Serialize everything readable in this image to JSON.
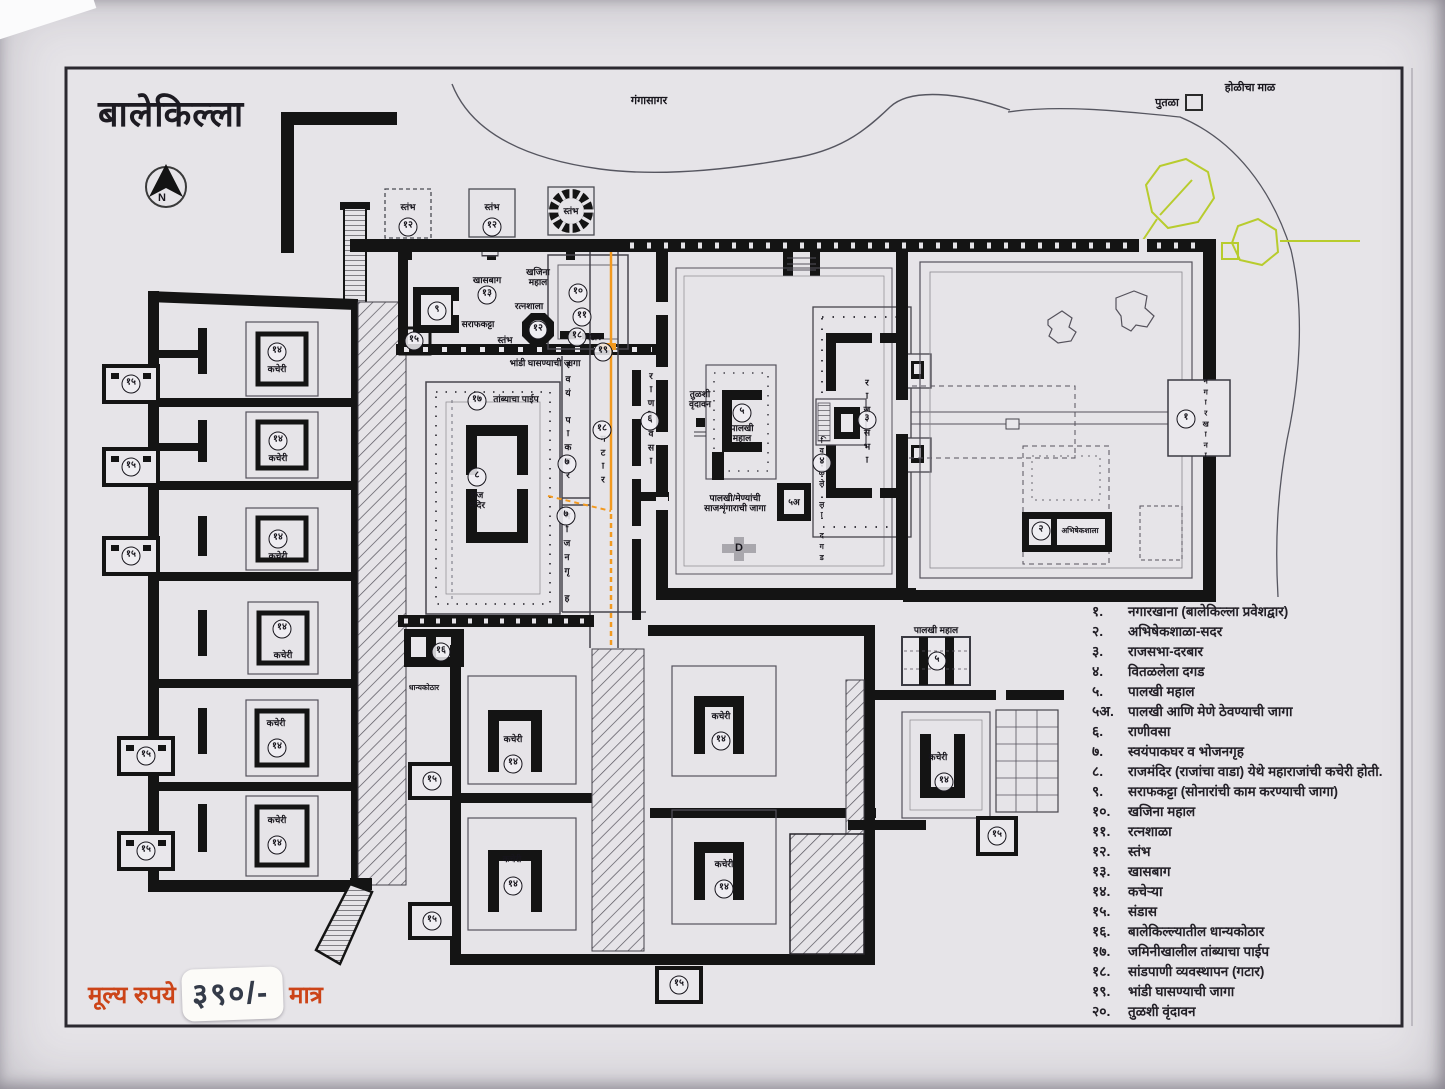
{
  "page": {
    "title": "बालेकिल्ला"
  },
  "price": {
    "prefix": "मूल्य रुपये",
    "value": "३९०/-",
    "suffix": "मात्र"
  },
  "colors": {
    "wall": "#141414",
    "paper": "#e6e4e8",
    "accent_green": "#b8cc2e",
    "accent_orange": "#f2991f",
    "price_red": "#cc4418"
  },
  "legend": {
    "items": [
      {
        "n": "१.",
        "t": "नगारखाना (बालेकिल्ला प्रवेशद्वार)"
      },
      {
        "n": "२.",
        "t": "अभिषेकशाळा-सदर"
      },
      {
        "n": "३.",
        "t": "राजसभा-दरबार"
      },
      {
        "n": "४.",
        "t": "वितळलेला दगड"
      },
      {
        "n": "५.",
        "t": "पालखी महाल"
      },
      {
        "n": "५अ.",
        "t": "पालखी आणि मेणे ठेवण्याची जागा"
      },
      {
        "n": "६.",
        "t": "राणीवसा"
      },
      {
        "n": "७.",
        "t": "स्वयंपाकघर व भोजनगृह"
      },
      {
        "n": "८.",
        "t": "राजमंदिर (राजांचा वाडा) येथे महाराजांची कचेरी होती."
      },
      {
        "n": "९.",
        "t": "सराफकट्टा (सोनारांची काम करण्याची जागा)"
      },
      {
        "n": "१०.",
        "t": "खजिना महाल"
      },
      {
        "n": "११.",
        "t": "रत्नशाळा"
      },
      {
        "n": "१२.",
        "t": "स्तंभ"
      },
      {
        "n": "१३.",
        "t": "खासबाग"
      },
      {
        "n": "१४.",
        "t": "कचेऱ्या"
      },
      {
        "n": "१५.",
        "t": "संडास"
      },
      {
        "n": "१६.",
        "t": "बालेकिल्ल्यातील धान्यकोठार"
      },
      {
        "n": "१७.",
        "t": "जमिनीखालील तांब्याचा पाईप"
      },
      {
        "n": "१८.",
        "t": "सांडपाणी व्यवस्थापन (गटार)"
      },
      {
        "n": "१९.",
        "t": "भांडी घासण्याची जागा"
      },
      {
        "n": "२०.",
        "t": "तुळशी वृंदावन"
      }
    ]
  },
  "plan": {
    "labels": [
      {
        "t": "गंगासागर",
        "x": 649,
        "y": 101
      },
      {
        "t": "होळीचा माळ",
        "x": 1250,
        "y": 88
      },
      {
        "t": "पुतळा",
        "x": 1167,
        "y": 103
      },
      {
        "t": "N",
        "x": 162,
        "y": 198
      },
      {
        "t": "स्तंभ",
        "x": 408,
        "y": 207,
        "s": 1
      },
      {
        "t": "स्तंभ",
        "x": 492,
        "y": 207,
        "s": 1
      },
      {
        "t": "स्तंभ",
        "x": 571,
        "y": 211,
        "s": 1
      },
      {
        "t": "खासबाग",
        "x": 487,
        "y": 280,
        "s": 1
      },
      {
        "t": "खजिना\nमहाल",
        "x": 538,
        "y": 277,
        "s": 1
      },
      {
        "t": "रत्नशाला",
        "x": 529,
        "y": 306,
        "s": 1
      },
      {
        "t": "सराफकट्टा",
        "x": 478,
        "y": 324,
        "s": 1
      },
      {
        "t": "स्तंभ",
        "x": 505,
        "y": 340,
        "s": 1
      },
      {
        "t": "गटार",
        "x": 593,
        "y": 337,
        "s": 1
      },
      {
        "t": "भांडी घासण्याची जागा",
        "x": 545,
        "y": 363,
        "s": 1
      },
      {
        "t": "तांब्याचा पाईप",
        "x": 516,
        "y": 399,
        "s": 1
      },
      {
        "t": "स्वयंपाकघर",
        "x": 567,
        "y": 420,
        "v": 1,
        "s": 1
      },
      {
        "t": "भोजनगृह",
        "x": 566,
        "y": 557,
        "v": 1,
        "s": 1
      },
      {
        "t": "गटार",
        "x": 602,
        "y": 459,
        "v": 1,
        "s": 1
      },
      {
        "t": "राणी",
        "x": 650,
        "y": 396,
        "v": 1,
        "s": 1
      },
      {
        "t": "वसा",
        "x": 650,
        "y": 447,
        "v": 1,
        "s": 1
      },
      {
        "t": "तुळशी\nवृंदावन",
        "x": 700,
        "y": 399,
        "s": 1
      },
      {
        "t": "राज\nमंदिर",
        "x": 477,
        "y": 500,
        "s": 1
      },
      {
        "t": "पालखी\nमहाल",
        "x": 742,
        "y": 433,
        "s": 1
      },
      {
        "t": "पालखी/मेण्यांची\nसाजशृंगाराची जागा",
        "x": 735,
        "y": 503,
        "s": 1
      },
      {
        "t": "५अ",
        "x": 794,
        "y": 502,
        "s": 1
      },
      {
        "t": "D",
        "x": 739,
        "y": 548
      },
      {
        "t": "राज",
        "x": 866,
        "y": 396,
        "v": 1,
        "s": 1
      },
      {
        "t": "सभा",
        "x": 866,
        "y": 446,
        "v": 1,
        "s": 1
      },
      {
        "t": "वितळलेला दगड",
        "x": 822,
        "y": 500,
        "v": 1,
        "xs": 1
      },
      {
        "t": "अभिषेकशाला",
        "x": 1080,
        "y": 531,
        "xs": 1
      },
      {
        "t": "नगारखाना",
        "x": 1206,
        "y": 419,
        "v": 1,
        "xs": 1
      },
      {
        "t": "कचेरी",
        "x": 277,
        "y": 369,
        "s": 1
      },
      {
        "t": "कचेरी",
        "x": 278,
        "y": 458,
        "s": 1
      },
      {
        "t": "कचेरी",
        "x": 278,
        "y": 556,
        "s": 1
      },
      {
        "t": "कचेरी",
        "x": 283,
        "y": 655,
        "s": 1
      },
      {
        "t": "कचेरी",
        "x": 276,
        "y": 723,
        "s": 1
      },
      {
        "t": "कचेरी",
        "x": 277,
        "y": 820,
        "s": 1
      },
      {
        "t": "कचेरी",
        "x": 513,
        "y": 739,
        "s": 1
      },
      {
        "t": "कचेरी",
        "x": 512,
        "y": 859,
        "s": 1
      },
      {
        "t": "कचेरी",
        "x": 721,
        "y": 716,
        "s": 1
      },
      {
        "t": "कचेरी",
        "x": 724,
        "y": 864,
        "s": 1
      },
      {
        "t": "कचेरी",
        "x": 938,
        "y": 757,
        "s": 1
      },
      {
        "t": "धान्यकोठार",
        "x": 424,
        "y": 688,
        "xs": 1
      },
      {
        "t": "पालखी महाल",
        "x": 936,
        "y": 630,
        "s": 1
      }
    ],
    "markers": [
      {
        "n": "१२",
        "x": 408,
        "y": 227
      },
      {
        "n": "१२",
        "x": 492,
        "y": 227
      },
      {
        "n": "१३",
        "x": 487,
        "y": 295
      },
      {
        "n": "१०",
        "x": 578,
        "y": 293
      },
      {
        "n": "११",
        "x": 582,
        "y": 317
      },
      {
        "n": "९",
        "x": 437,
        "y": 311
      },
      {
        "n": "१२",
        "x": 538,
        "y": 330
      },
      {
        "n": "१८",
        "x": 577,
        "y": 337
      },
      {
        "n": "१९",
        "x": 603,
        "y": 352
      },
      {
        "n": "१७",
        "x": 477,
        "y": 401
      },
      {
        "n": "७",
        "x": 567,
        "y": 464
      },
      {
        "n": "७",
        "x": 566,
        "y": 516
      },
      {
        "n": "१८",
        "x": 602,
        "y": 430
      },
      {
        "n": "६",
        "x": 650,
        "y": 421
      },
      {
        "n": "८",
        "x": 477,
        "y": 477
      },
      {
        "n": "५",
        "x": 742,
        "y": 413
      },
      {
        "n": "३",
        "x": 867,
        "y": 420
      },
      {
        "n": "४",
        "x": 822,
        "y": 463
      },
      {
        "n": "२",
        "x": 1041,
        "y": 531
      },
      {
        "n": "१",
        "x": 1186,
        "y": 419
      },
      {
        "n": "१४",
        "x": 277,
        "y": 352
      },
      {
        "n": "१४",
        "x": 278,
        "y": 441
      },
      {
        "n": "१४",
        "x": 278,
        "y": 539
      },
      {
        "n": "१४",
        "x": 282,
        "y": 629
      },
      {
        "n": "१४",
        "x": 277,
        "y": 748
      },
      {
        "n": "१४",
        "x": 277,
        "y": 845
      },
      {
        "n": "१४",
        "x": 513,
        "y": 764
      },
      {
        "n": "१४",
        "x": 513,
        "y": 886
      },
      {
        "n": "१४",
        "x": 721,
        "y": 741
      },
      {
        "n": "१४",
        "x": 724,
        "y": 889
      },
      {
        "n": "१४",
        "x": 944,
        "y": 782
      },
      {
        "n": "१६",
        "x": 441,
        "y": 652
      },
      {
        "n": "५",
        "x": 937,
        "y": 661
      },
      {
        "n": "१५",
        "x": 131,
        "y": 384
      },
      {
        "n": "१५",
        "x": 131,
        "y": 467
      },
      {
        "n": "१५",
        "x": 131,
        "y": 556
      },
      {
        "n": "१५",
        "x": 146,
        "y": 756
      },
      {
        "n": "१५",
        "x": 146,
        "y": 851
      },
      {
        "n": "१५",
        "x": 414,
        "y": 341
      },
      {
        "n": "१५",
        "x": 432,
        "y": 781
      },
      {
        "n": "१५",
        "x": 432,
        "y": 921
      },
      {
        "n": "१५",
        "x": 679,
        "y": 985
      },
      {
        "n": "१५",
        "x": 997,
        "y": 836
      }
    ]
  }
}
